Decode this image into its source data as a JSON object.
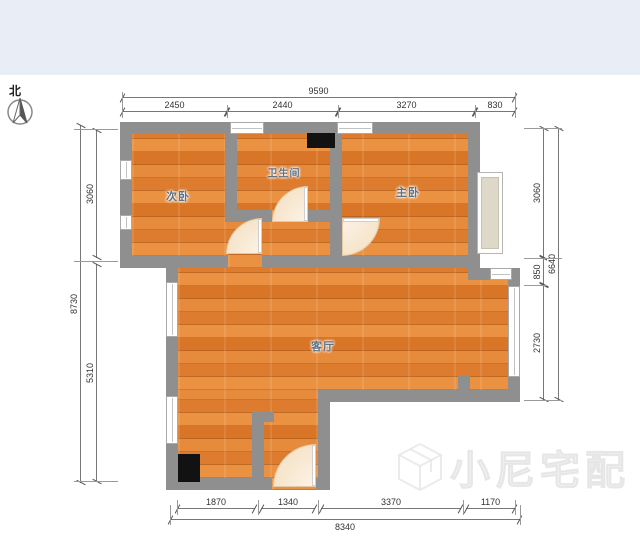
{
  "page": {
    "top_bar_color": "#e9edf6",
    "background": "#ffffff"
  },
  "north": {
    "label": "北"
  },
  "rooms": {
    "secondary_bedroom": "次卧",
    "bathroom": "卫生间",
    "master_bedroom": "主卧",
    "living_room": "客厅"
  },
  "dimensions": {
    "top": {
      "total": "9590",
      "segments": [
        "2450",
        "2440",
        "3270",
        "830"
      ]
    },
    "bottom": {
      "total": "8340",
      "segments": [
        "1870",
        "1340",
        "3370",
        "1170"
      ]
    },
    "left": {
      "total": "8730",
      "segments": [
        "3060",
        "5310"
      ]
    },
    "right": {
      "total": "6640",
      "segments": [
        "3060",
        "850",
        "2730"
      ]
    }
  },
  "watermark": {
    "text": "小尼宅配"
  },
  "colors": {
    "floor": "#e0813a",
    "wall": "#8f8f8f",
    "bay_window_fill": "#ddd8c7",
    "door_arc": "#f8ebd9",
    "flue_box": "#121212"
  }
}
